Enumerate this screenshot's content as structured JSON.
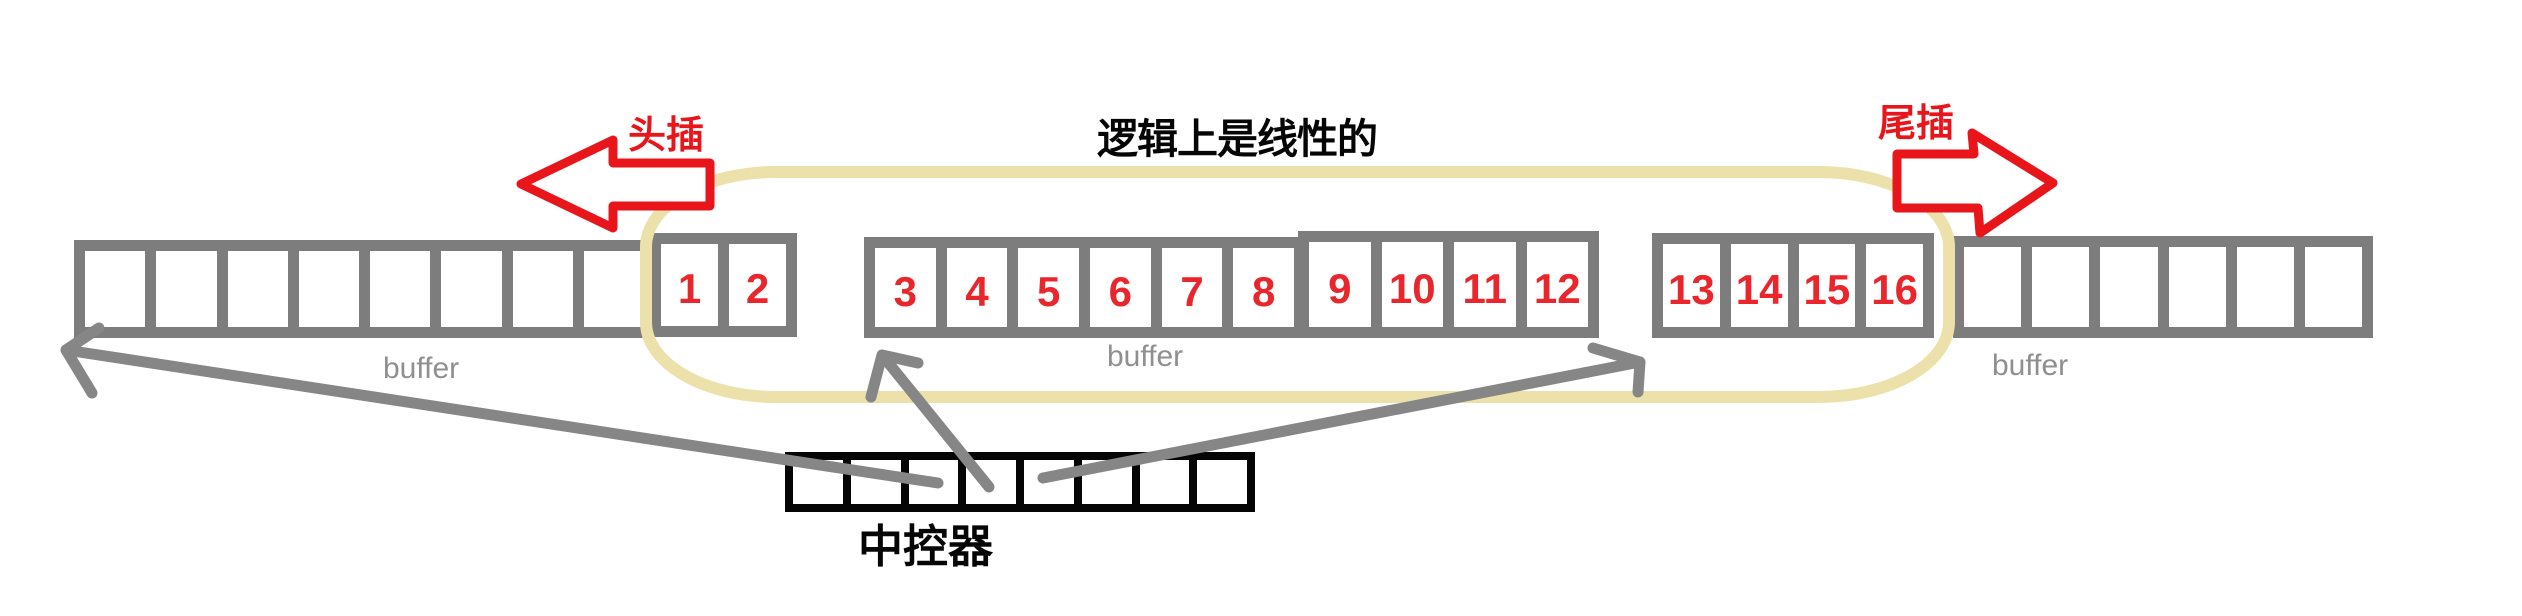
{
  "canvas": {
    "width": 2522,
    "height": 616,
    "background": "#ffffff"
  },
  "colors": {
    "red": "#e8151b",
    "number-red": "#e8262c",
    "border-gray": "#7d7d7d",
    "arrow-gray": "#868686",
    "label-gray": "#8f8f8f",
    "yellow": "#ece1ab",
    "black": "#050505",
    "bg": "#ffffff"
  },
  "labels": {
    "head_insert": "头插",
    "tail_insert": "尾插",
    "title": "逻辑上是线性的",
    "controller": "中控器",
    "buffer_left": "buffer",
    "buffer_middle": "buffer",
    "buffer_right": "buffer"
  },
  "buffers": [
    {
      "name": "left-buffer-empty-cells",
      "x": 74,
      "y": 240,
      "w": 581,
      "h": 98,
      "cells": [
        "",
        "",
        "",
        "",
        "",
        "",
        "",
        ""
      ]
    },
    {
      "name": "left-buffer-head-cells",
      "x": 650,
      "y": 233,
      "w": 147,
      "h": 104,
      "cells": [
        "1",
        "2"
      ]
    },
    {
      "name": "middle-buffer-cells-3-8",
      "x": 864,
      "y": 237,
      "w": 441,
      "h": 101,
      "cells": [
        "3",
        "4",
        "5",
        "6",
        "7",
        "8"
      ]
    },
    {
      "name": "middle-buffer-cells-9-12",
      "x": 1298,
      "y": 231,
      "w": 301,
      "h": 107,
      "cells": [
        "9",
        "10",
        "11",
        "12"
      ]
    },
    {
      "name": "right-buffer-tail-cells",
      "x": 1652,
      "y": 233,
      "w": 282,
      "h": 105,
      "cells": [
        "13",
        "14",
        "15",
        "16"
      ]
    },
    {
      "name": "right-buffer-empty-cells",
      "x": 1953,
      "y": 236,
      "w": 420,
      "h": 102,
      "cells": [
        "",
        "",
        "",
        "",
        "",
        ""
      ]
    }
  ],
  "controller": {
    "x": 785,
    "y": 452,
    "w": 470,
    "h": 60,
    "cell_count": 8
  }
}
